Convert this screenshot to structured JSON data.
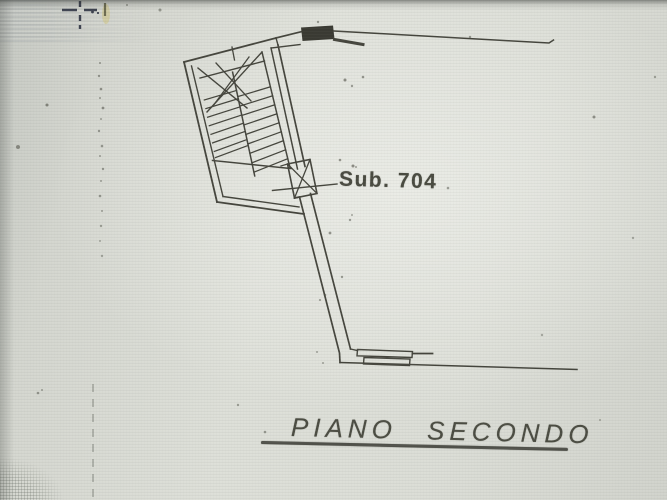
{
  "photo": {
    "kind": "photograph of a scanned cadastral floor plan",
    "paper_color": "#dcded7",
    "ink_color": "#3d3e35"
  },
  "plan": {
    "unit_label": "Sub. 704",
    "floor_label": "PIANO SECONDO",
    "symbols": [
      {
        "name": "registration-cross-icon"
      },
      {
        "name": "staircase-symbol"
      },
      {
        "name": "door-opening-symbol"
      },
      {
        "name": "window-symbol"
      },
      {
        "name": "corridor-walls"
      }
    ]
  }
}
